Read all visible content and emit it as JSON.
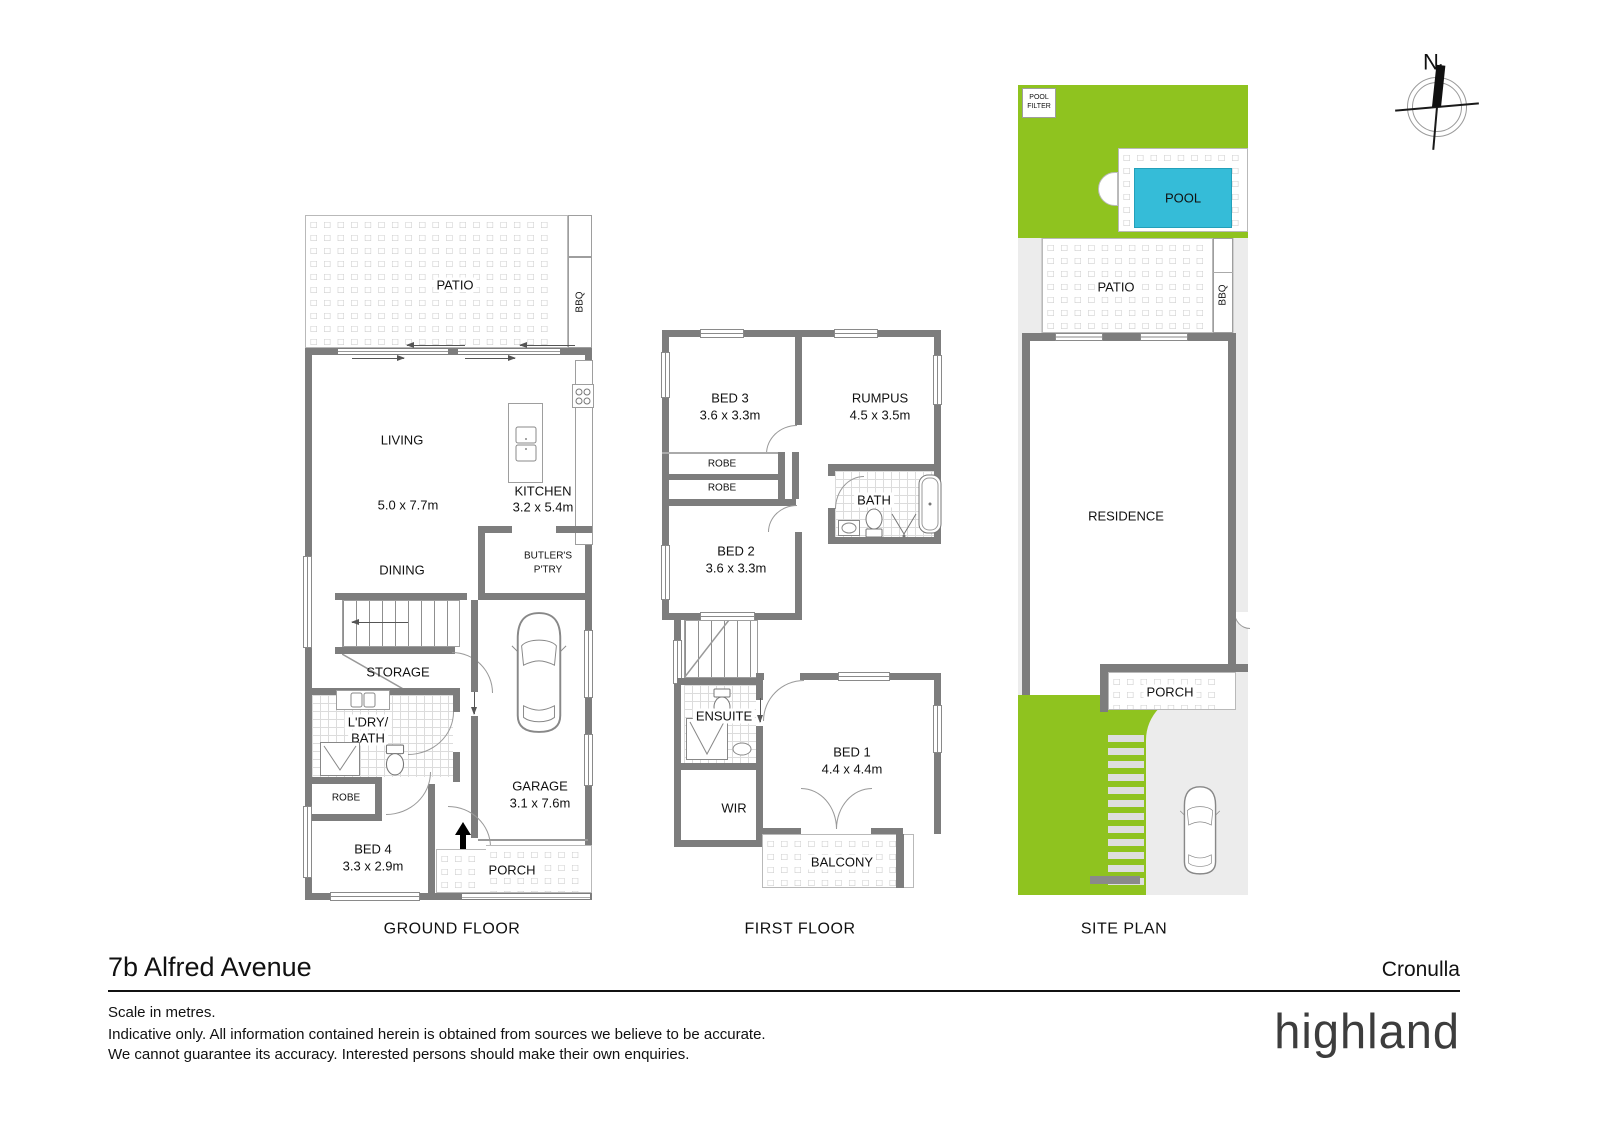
{
  "colors": {
    "lawn": "#8fc31f",
    "pool": "#35bcd8",
    "wall": "#7d7d7d",
    "paving": "#ececec"
  },
  "compass": {
    "north": "N"
  },
  "ground_floor": {
    "title": "GROUND FLOOR",
    "patio": "PATIO",
    "bbq": "BBQ",
    "living": "LIVING",
    "living_dim": "5.0 x 7.7m",
    "kitchen": "KITCHEN",
    "kitchen_dim": "3.2 x 5.4m",
    "dining": "DINING",
    "butlers_line1": "BUTLER'S",
    "butlers_line2": "P'TRY",
    "storage": "STORAGE",
    "laundry_line1": "L'DRY/",
    "laundry_line2": "BATH",
    "robe": "ROBE",
    "bed4": "BED 4",
    "bed4_dim": "3.3 x 2.9m",
    "garage": "GARAGE",
    "garage_dim": "3.1 x 7.6m",
    "porch": "PORCH"
  },
  "first_floor": {
    "title": "FIRST FLOOR",
    "bed3": "BED 3",
    "bed3_dim": "3.6 x 3.3m",
    "rumpus": "RUMPUS",
    "rumpus_dim": "4.5 x 3.5m",
    "robe1": "ROBE",
    "robe2": "ROBE",
    "bath": "BATH",
    "bed2": "BED 2",
    "bed2_dim": "3.6 x 3.3m",
    "ensuite": "ENSUITE",
    "wir": "WIR",
    "bed1": "BED 1",
    "bed1_dim": "4.4 x 4.4m",
    "balcony": "BALCONY"
  },
  "site_plan": {
    "title": "SITE PLAN",
    "pool_filter_line1": "POOL",
    "pool_filter_line2": "FILTER",
    "pool": "POOL",
    "patio": "PATIO",
    "bbq": "BBQ",
    "residence": "RESIDENCE",
    "porch": "PORCH"
  },
  "footer": {
    "address": "7b Alfred Avenue",
    "suburb": "Cronulla",
    "scale_note": "Scale in metres.",
    "disclaimer_1": "Indicative only. All information contained herein is obtained from sources we believe to be accurate.",
    "disclaimer_2": "We cannot guarantee its accuracy. Interested persons should make their own enquiries.",
    "brand": "highland"
  }
}
